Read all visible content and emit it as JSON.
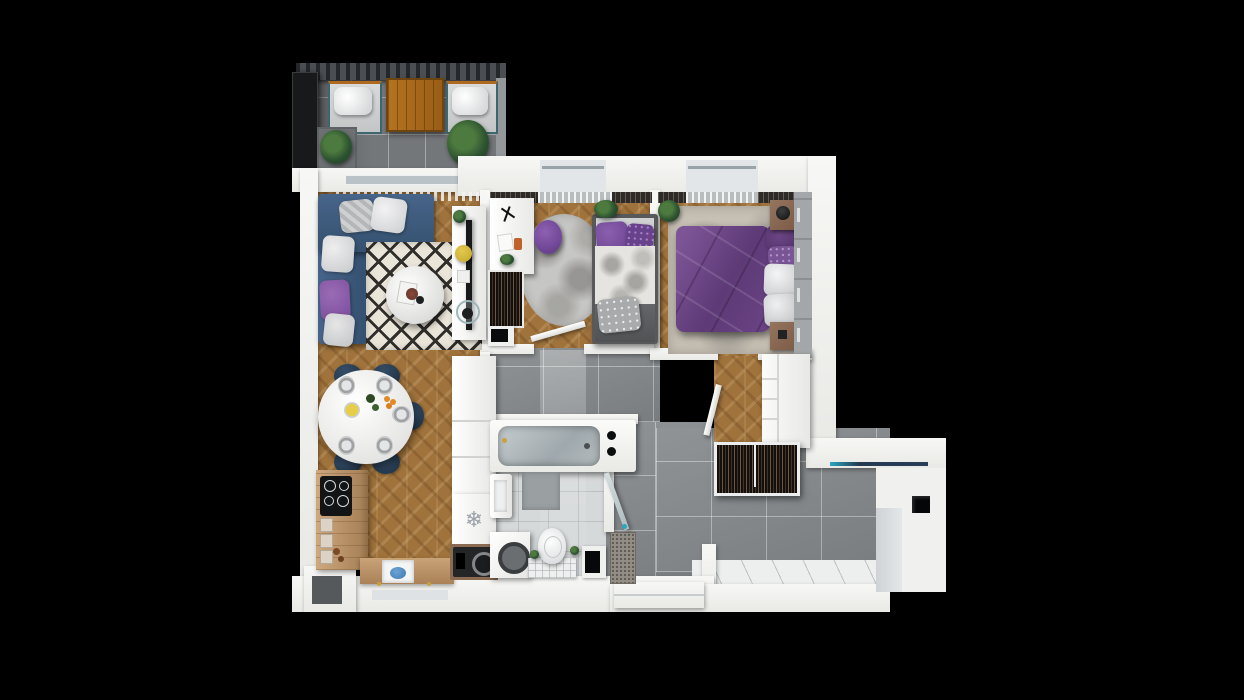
{
  "scene": {
    "type": "3d-floor-plan-render",
    "background": "#000000",
    "description": "Top-down 3D architectural render of a two-bedroom apartment with balcony, on black background, no text labels",
    "glyphs": {
      "snowflake": "❄"
    },
    "palette": {
      "wall_white": "#f4f4f2",
      "wood_floor": "#a0733c",
      "hall_tile_gray": "#83878a",
      "balcony_tile": "#74777a",
      "sofa_navy": "#3a5676",
      "chair_navy": "#22364a",
      "bed_purple": "#6a4384",
      "accent_purple": "#7b50a0",
      "rug_cream": "#eae5d9",
      "rug_pattern_black": "#312f2c",
      "plant_green": "#2c5230",
      "counter_wood": "#c9a379",
      "stool_yellow": "#d4b83a",
      "appliance_dark": "#232527",
      "tub_steel": "#aeb6ba",
      "glass_blue": "#2a3e56"
    },
    "rooms": [
      {
        "id": "balcony",
        "label": "Balcony",
        "floor": "dark gray tiles",
        "furniture": [
          "pergola slats",
          "privacy screen",
          "lounge chair",
          "wooden table",
          "lounge chair",
          "potted plant",
          "potted plant"
        ]
      },
      {
        "id": "living-room",
        "label": "Living room",
        "floor": "herringbone wood",
        "furniture": [
          "navy corner sofa",
          "throw pillows",
          "black-white diamond rug",
          "round coffee table",
          "tv console",
          "tv",
          "yellow stool",
          "plant"
        ]
      },
      {
        "id": "dining-area",
        "label": "Dining area",
        "floor": "herringbone wood",
        "furniture": [
          "oval dining table",
          "navy chairs x5",
          "table settings"
        ]
      },
      {
        "id": "kitchen",
        "label": "Kitchen",
        "floor": "herringbone wood",
        "furniture": [
          "induction hob",
          "wooden counter",
          "drawers",
          "sink with blue basin",
          "tall cabinet",
          "fridge with snowflake mark",
          "dark built-in appliance"
        ]
      },
      {
        "id": "bedroom-small",
        "label": "Small bedroom",
        "floor": "herringbone wood",
        "furniture": [
          "white desk",
          "purple chair",
          "open wardrobe",
          "dresser",
          "fluffy gray rug",
          "single bed with purple pillows",
          "plant"
        ]
      },
      {
        "id": "bedroom-master",
        "label": "Master bedroom",
        "floor": "herringbone wood",
        "furniture": [
          "double bed with purple duvet",
          "white pillows",
          "nightstand with lamp",
          "nightstand",
          "sliding-door wardrobe",
          "mottled area rug",
          "plant"
        ]
      },
      {
        "id": "bathroom",
        "label": "Bathroom",
        "floor": "light gray tiles",
        "furniture": [
          "bathtub with two knobs",
          "washbasin",
          "washing machine",
          "toilet",
          "tiled cistern shelf",
          "bath mat",
          "glass door"
        ]
      },
      {
        "id": "hallway",
        "label": "Hallway / entry",
        "floor": "large gray tiles",
        "furniture": [
          "open clothes rack",
          "white cabinet",
          "interior doors",
          "speckled doormat",
          "entry step",
          "window strip",
          "dark wall niche"
        ]
      }
    ]
  }
}
